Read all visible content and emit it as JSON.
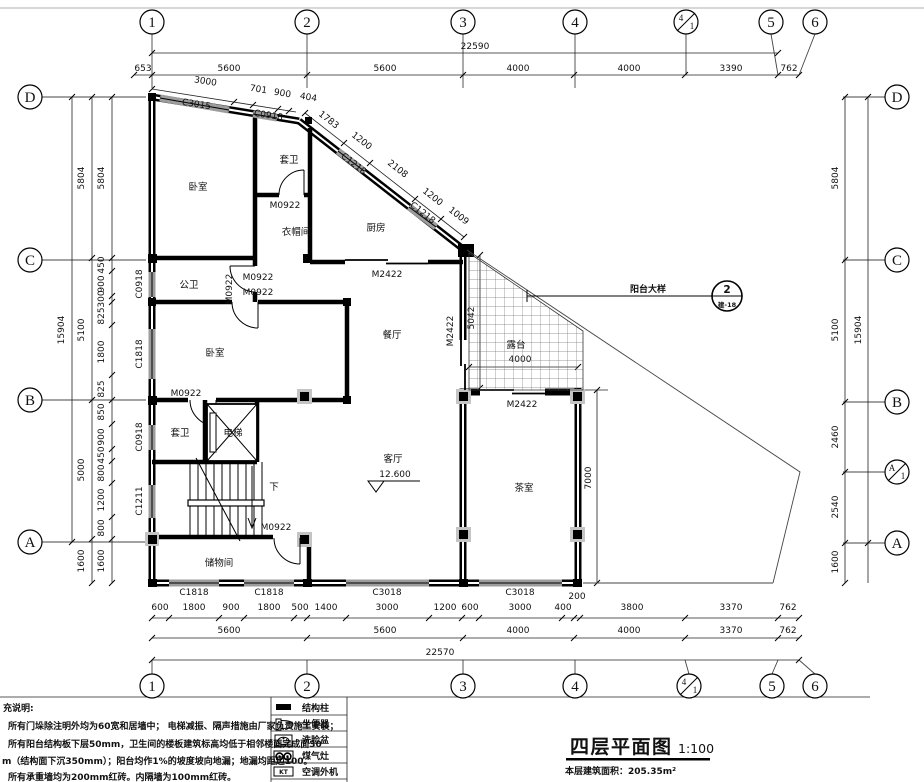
{
  "axes": {
    "c1": "1",
    "c2": "2",
    "c3": "3",
    "c4": "4",
    "c5": "5",
    "c6": "6",
    "sub1": "1",
    "cD": "D",
    "cC": "C",
    "cB": "B",
    "cA": "A"
  },
  "dims": {
    "h_top1": [
      "653",
      "5600",
      "5600",
      "4000",
      "4000",
      "3390",
      "762"
    ],
    "h_top_total": "22590",
    "slope": [
      "3000",
      "701",
      "900",
      "404"
    ],
    "diag": [
      "1783",
      "1200",
      "2108",
      "1200",
      "1009"
    ],
    "v_left_total": "15904",
    "v_left_main": [
      "5804",
      "5100",
      "5000",
      "1600"
    ],
    "v_left_fine": [
      "5804",
      "450",
      "900",
      "300",
      "825",
      "1800",
      "825",
      "850",
      "900",
      "450",
      "800",
      "1200",
      "800",
      "1600"
    ],
    "v_right_main": [
      "5804",
      "5100",
      "2460",
      "2540",
      "1600"
    ],
    "v_right_total": "15904",
    "h_bot1": [
      "600",
      "1800",
      "900",
      "1800",
      "500",
      "1400",
      "3000",
      "1200",
      "600",
      "3000",
      "400",
      "200",
      "3800",
      "3370",
      "762"
    ],
    "h_bot2": [
      "5600",
      "5600",
      "4000",
      "4000",
      "3370",
      "762"
    ],
    "h_bot_total": "22570",
    "terrace_w": "4000",
    "terrace_h": "5042",
    "tea_h": "7000"
  },
  "openings": {
    "c3015": "C3015",
    "c0918": "C0918",
    "c1218": "C1218",
    "c1818": "C1818",
    "c1211": "C1211",
    "c3018": "C3018",
    "m0922": "M0922",
    "m2422": "M2422"
  },
  "rooms": {
    "bedroom": "卧室",
    "ensuite": "套卫",
    "cloakroom": "衣帽间",
    "kitchen": "厨房",
    "public_wc": "公卫",
    "dining": "餐厅",
    "living": "客厅",
    "tea": "茶室",
    "terrace": "露台",
    "storage": "储物间",
    "elevator": "电梯",
    "down": "下",
    "level": "12.600"
  },
  "callout": {
    "label": "阳台大样",
    "num": "2",
    "ref": "建-18"
  },
  "title_block": {
    "title": "四层平面图",
    "scale": "1:100",
    "area": "本层建筑面积：205.35m²"
  },
  "notes": {
    "header": "充说明:",
    "line1": "所有门垛除注明外均为60宽和居墙中； 电梯减振、隔声措施由厂家负责施工安装；",
    "line2": "所有阳台结构板下层50mm，卫生间的楼板建筑标高均低于相邻楼面完成面30",
    "line3": "m（结构面下沉350mm）；阳台均作1%的坡度坡向地漏；地漏均距边100。",
    "line4": "所有承重墙均为200mm红砖。内隔墙为100mm红砖。"
  },
  "legend": {
    "items": [
      {
        "label": "结构柱"
      },
      {
        "label": "坐便器"
      },
      {
        "label": "洗脸盆"
      },
      {
        "label": "煤气灶"
      },
      {
        "label": "空调外机"
      }
    ],
    "ac_text": "KT"
  }
}
